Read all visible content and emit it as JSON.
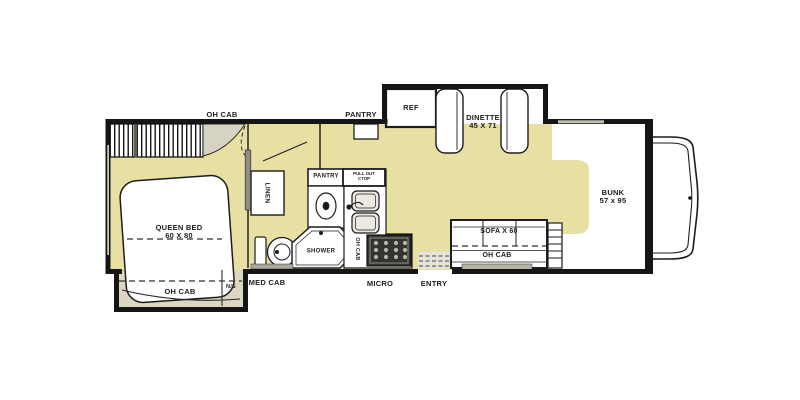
{
  "floorplan": {
    "title": "RV Class C floor plan",
    "colors": {
      "floor_tan": "#e8e0a2",
      "wall_black": "#151515",
      "shade_gray": "#d6d3c2",
      "cabinet_gray": "#aaa89c"
    },
    "bedroom": {
      "oh_cab_top": "OH CAB",
      "queen_bed": "QUEEN BED",
      "queen_bed_size": "60 X 80",
      "oh_cab_slide": "OH CAB",
      "night_stand": "N/S",
      "linen": "LINEN"
    },
    "bathroom": {
      "med_cab": "MED CAB",
      "pantry": "PANTRY",
      "shower": "SHOWER"
    },
    "kitchen": {
      "pantry_top": "PANTRY",
      "pull_out_line1": "PULL OUT",
      "pull_out_line2": "CTOP",
      "oh_cab": "OH CAB",
      "micro": "MICRO"
    },
    "living": {
      "ref": "REF",
      "dinette": "DINETTE",
      "dinette_size": "45 X 71",
      "sofa": "SOFA X 60",
      "oh_cab": "OH CAB",
      "entry": "ENTRY"
    },
    "front": {
      "bunk": "BUNK",
      "bunk_size": "57 x 95"
    }
  }
}
